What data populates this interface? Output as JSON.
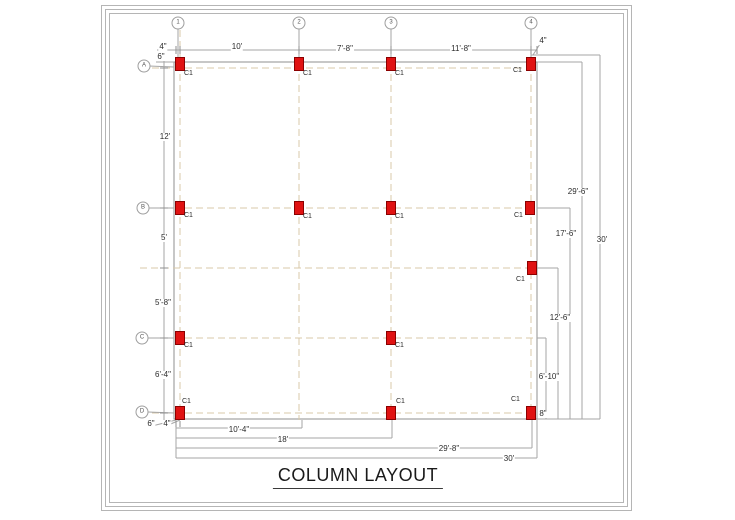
{
  "title": {
    "text": "COLUMN LAYOUT"
  },
  "colors": {
    "column_fill": "#e01212",
    "column_border": "#8b0000",
    "grid_dash": "#d9c8a9",
    "dimension_line": "#a6a6a6",
    "building_outline": "#8f8f8f",
    "frame": "#b5b5b5",
    "text": "#2b2b2b"
  },
  "drawing": {
    "column_type_label": "C1",
    "column_size": {
      "w": 9,
      "h": 13
    },
    "building": {
      "x": 174,
      "y": 62,
      "w": 363,
      "h": 357
    },
    "grid_bubbles": [
      {
        "id": "1",
        "x": 178,
        "y": 23
      },
      {
        "id": "2",
        "x": 299,
        "y": 23
      },
      {
        "id": "3",
        "x": 391,
        "y": 23
      },
      {
        "id": "4",
        "x": 531,
        "y": 23
      },
      {
        "id": "A",
        "x": 144,
        "y": 66
      },
      {
        "id": "B",
        "x": 143,
        "y": 208
      },
      {
        "id": "C",
        "x": 142,
        "y": 338
      },
      {
        "id": "D",
        "x": 142,
        "y": 412
      }
    ],
    "columns": [
      {
        "x": 180,
        "y": 64,
        "lx": 184,
        "ly": 70
      },
      {
        "x": 299,
        "y": 64,
        "lx": 303,
        "ly": 70
      },
      {
        "x": 391,
        "y": 64,
        "lx": 395,
        "ly": 70
      },
      {
        "x": 531,
        "y": 64,
        "lx": 513,
        "ly": 67
      },
      {
        "x": 180,
        "y": 208,
        "lx": 184,
        "ly": 212
      },
      {
        "x": 299,
        "y": 208,
        "lx": 303,
        "ly": 213
      },
      {
        "x": 391,
        "y": 208,
        "lx": 395,
        "ly": 213
      },
      {
        "x": 530,
        "y": 208,
        "lx": 514,
        "ly": 212
      },
      {
        "x": 532,
        "y": 268,
        "lx": 516,
        "ly": 276
      },
      {
        "x": 180,
        "y": 338,
        "lx": 184,
        "ly": 342
      },
      {
        "x": 391,
        "y": 338,
        "lx": 395,
        "ly": 342
      },
      {
        "x": 180,
        "y": 413,
        "lx": 182,
        "ly": 398
      },
      {
        "x": 391,
        "y": 413,
        "lx": 396,
        "ly": 398
      },
      {
        "x": 531,
        "y": 413,
        "lx": 511,
        "ly": 396
      }
    ],
    "dimensions": {
      "top": [
        {
          "text": "4\"",
          "x": 163,
          "y": 47
        },
        {
          "text": "10'",
          "x": 237,
          "y": 47
        },
        {
          "text": "7'-8\"",
          "x": 345,
          "y": 49
        },
        {
          "text": "11'-8\"",
          "x": 461,
          "y": 49
        },
        {
          "text": "4\"",
          "x": 543,
          "y": 41
        }
      ],
      "left": [
        {
          "text": "6\"",
          "x": 161,
          "y": 57
        },
        {
          "text": "12'",
          "x": 165,
          "y": 137
        },
        {
          "text": "5'",
          "x": 164,
          "y": 238
        },
        {
          "text": "5'-8\"",
          "x": 163,
          "y": 303
        },
        {
          "text": "6'-4\"",
          "x": 163,
          "y": 375
        },
        {
          "text": "6\"",
          "x": 151,
          "y": 424
        },
        {
          "text": "4\"",
          "x": 167,
          "y": 424
        }
      ],
      "right": [
        {
          "text": "29'-6\"",
          "x": 578,
          "y": 192
        },
        {
          "text": "17'-6\"",
          "x": 566,
          "y": 234
        },
        {
          "text": "30'",
          "x": 602,
          "y": 240
        },
        {
          "text": "12'-6\"",
          "x": 560,
          "y": 318
        },
        {
          "text": "6'-10\"",
          "x": 549,
          "y": 377
        },
        {
          "text": "8\"",
          "x": 543,
          "y": 414
        }
      ],
      "bottom": [
        {
          "text": "10'-4\"",
          "x": 239,
          "y": 430
        },
        {
          "text": "18'",
          "x": 283,
          "y": 440
        },
        {
          "text": "29'-8\"",
          "x": 449,
          "y": 449
        },
        {
          "text": "30'",
          "x": 509,
          "y": 459
        }
      ]
    },
    "lines": [
      {
        "x1": 180,
        "y1": 30,
        "x2": 180,
        "y2": 420,
        "k": "grid"
      },
      {
        "x1": 299,
        "y1": 30,
        "x2": 299,
        "y2": 420,
        "k": "grid"
      },
      {
        "x1": 391,
        "y1": 30,
        "x2": 391,
        "y2": 420,
        "k": "grid"
      },
      {
        "x1": 531,
        "y1": 30,
        "x2": 531,
        "y2": 420,
        "k": "grid"
      },
      {
        "x1": 152,
        "y1": 68,
        "x2": 537,
        "y2": 68,
        "k": "grid"
      },
      {
        "x1": 152,
        "y1": 208,
        "x2": 537,
        "y2": 208,
        "k": "grid"
      },
      {
        "x1": 140,
        "y1": 268,
        "x2": 537,
        "y2": 268,
        "k": "grid"
      },
      {
        "x1": 152,
        "y1": 338,
        "x2": 537,
        "y2": 338,
        "k": "grid"
      },
      {
        "x1": 152,
        "y1": 413,
        "x2": 537,
        "y2": 413,
        "k": "grid"
      },
      {
        "x1": 157,
        "y1": 50,
        "x2": 537,
        "y2": 50,
        "k": "dim"
      },
      {
        "x1": 164,
        "y1": 55,
        "x2": 164,
        "y2": 424,
        "k": "dim"
      },
      {
        "x1": 156,
        "y1": 62,
        "x2": 174,
        "y2": 62,
        "k": "dim"
      },
      {
        "x1": 531,
        "y1": 55,
        "x2": 600,
        "y2": 55,
        "k": "dim"
      },
      {
        "x1": 537,
        "y1": 62,
        "x2": 582,
        "y2": 62,
        "k": "dim"
      },
      {
        "x1": 533,
        "y1": 55,
        "x2": 540,
        "y2": 44,
        "k": "dim"
      },
      {
        "x1": 537,
        "y1": 208,
        "x2": 570,
        "y2": 208,
        "k": "dim"
      },
      {
        "x1": 537,
        "y1": 268,
        "x2": 558,
        "y2": 268,
        "k": "dim"
      },
      {
        "x1": 537,
        "y1": 338,
        "x2": 546,
        "y2": 338,
        "k": "dim"
      },
      {
        "x1": 537,
        "y1": 419,
        "x2": 600,
        "y2": 419,
        "k": "dim"
      },
      {
        "x1": 546,
        "y1": 338,
        "x2": 546,
        "y2": 419,
        "k": "dim"
      },
      {
        "x1": 558,
        "y1": 268,
        "x2": 558,
        "y2": 419,
        "k": "dim"
      },
      {
        "x1": 570,
        "y1": 208,
        "x2": 570,
        "y2": 419,
        "k": "dim"
      },
      {
        "x1": 582,
        "y1": 62,
        "x2": 582,
        "y2": 419,
        "k": "dim"
      },
      {
        "x1": 600,
        "y1": 55,
        "x2": 600,
        "y2": 419,
        "k": "dim"
      },
      {
        "x1": 176,
        "y1": 420,
        "x2": 176,
        "y2": 458,
        "k": "dim"
      },
      {
        "x1": 176,
        "y1": 428,
        "x2": 302,
        "y2": 428,
        "k": "dim"
      },
      {
        "x1": 176,
        "y1": 438,
        "x2": 392,
        "y2": 438,
        "k": "dim"
      },
      {
        "x1": 176,
        "y1": 448,
        "x2": 532,
        "y2": 448,
        "k": "dim"
      },
      {
        "x1": 176,
        "y1": 458,
        "x2": 537,
        "y2": 458,
        "k": "dim"
      },
      {
        "x1": 302,
        "y1": 420,
        "x2": 302,
        "y2": 428,
        "k": "dim"
      },
      {
        "x1": 392,
        "y1": 420,
        "x2": 392,
        "y2": 438,
        "k": "dim"
      },
      {
        "x1": 532,
        "y1": 420,
        "x2": 532,
        "y2": 448,
        "k": "dim"
      },
      {
        "x1": 537,
        "y1": 419,
        "x2": 537,
        "y2": 458,
        "k": "dim"
      },
      {
        "x1": 152,
        "y1": 426,
        "x2": 176,
        "y2": 420,
        "k": "dim"
      },
      {
        "x1": 166,
        "y1": 426,
        "x2": 180,
        "y2": 420,
        "k": "dim"
      },
      {
        "x1": 178,
        "y1": 29,
        "x2": 178,
        "y2": 57,
        "k": "dim"
      },
      {
        "x1": 299,
        "y1": 29,
        "x2": 299,
        "y2": 57,
        "k": "dim"
      },
      {
        "x1": 391,
        "y1": 29,
        "x2": 391,
        "y2": 57,
        "k": "dim"
      },
      {
        "x1": 531,
        "y1": 29,
        "x2": 531,
        "y2": 57,
        "k": "dim"
      },
      {
        "x1": 149,
        "y1": 66,
        "x2": 174,
        "y2": 67,
        "k": "dim"
      },
      {
        "x1": 149,
        "y1": 208,
        "x2": 174,
        "y2": 208,
        "k": "dim"
      },
      {
        "x1": 148,
        "y1": 338,
        "x2": 174,
        "y2": 338,
        "k": "dim"
      },
      {
        "x1": 148,
        "y1": 412,
        "x2": 174,
        "y2": 413,
        "k": "dim"
      },
      {
        "x1": 176,
        "y1": 46,
        "x2": 176,
        "y2": 54,
        "k": "tick"
      },
      {
        "x1": 180,
        "y1": 46,
        "x2": 180,
        "y2": 54,
        "k": "tick"
      },
      {
        "x1": 299,
        "y1": 46,
        "x2": 299,
        "y2": 54,
        "k": "tick"
      },
      {
        "x1": 391,
        "y1": 46,
        "x2": 391,
        "y2": 54,
        "k": "tick"
      },
      {
        "x1": 531,
        "y1": 46,
        "x2": 531,
        "y2": 54,
        "k": "tick"
      },
      {
        "x1": 537,
        "y1": 46,
        "x2": 537,
        "y2": 54,
        "k": "tick"
      },
      {
        "x1": 160,
        "y1": 68,
        "x2": 168,
        "y2": 68,
        "k": "tick"
      },
      {
        "x1": 160,
        "y1": 208,
        "x2": 168,
        "y2": 208,
        "k": "tick"
      },
      {
        "x1": 160,
        "y1": 268,
        "x2": 168,
        "y2": 268,
        "k": "tick"
      },
      {
        "x1": 160,
        "y1": 338,
        "x2": 168,
        "y2": 338,
        "k": "tick"
      },
      {
        "x1": 160,
        "y1": 413,
        "x2": 168,
        "y2": 413,
        "k": "tick"
      },
      {
        "x1": 176,
        "y1": 421,
        "x2": 176,
        "y2": 427,
        "k": "tick"
      },
      {
        "x1": 180,
        "y1": 421,
        "x2": 180,
        "y2": 427,
        "k": "tick"
      }
    ]
  }
}
